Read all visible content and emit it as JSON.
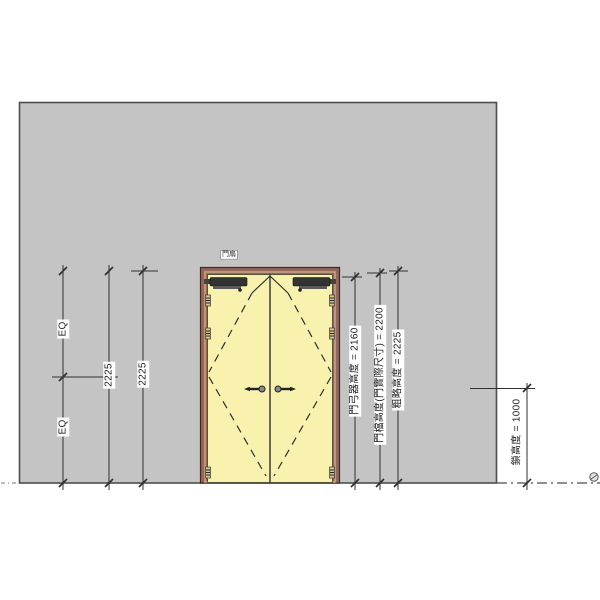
{
  "drawing": {
    "door_tag": "門扇",
    "left_dims": {
      "eq_top": "EQ",
      "eq_bottom": "EQ",
      "overall_height_1": "2225",
      "overall_height_2": "2225"
    },
    "right_dims": {
      "door_closer_height": "門弓器高度 = 2160",
      "door_actual_height": "門檔高度(門實際尺寸) = 2200",
      "rough_height": "粗略高度 = 2225"
    },
    "lock_dim": "鎖高度 = 1000",
    "colors": {
      "wall": "#c4c4c4",
      "wall_outline": "#4e4e4e",
      "door_leaf": "#f8f2ae",
      "door_frame": "#94675a",
      "frame_inner": "#c8a284",
      "hinge": "#d8c68e",
      "hardware": "#333333",
      "dimension_line": "#2f2f2f"
    }
  }
}
